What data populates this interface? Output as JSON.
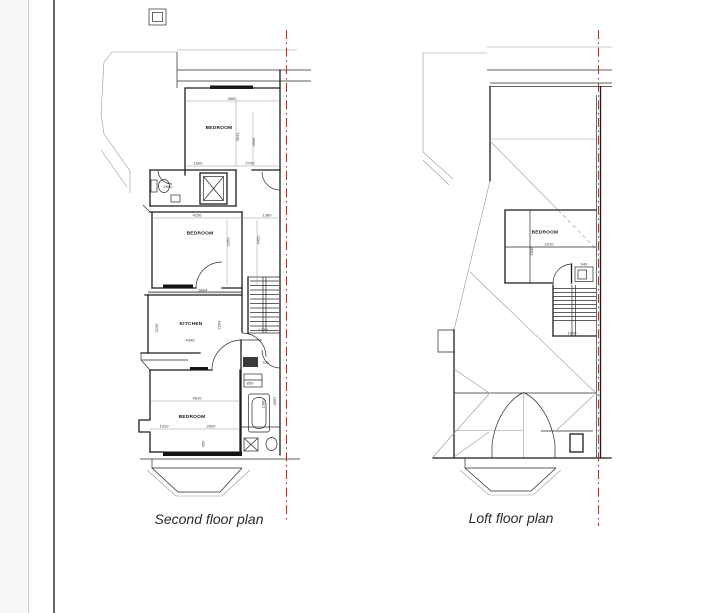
{
  "colors": {
    "boundary_red": "#b2382f",
    "wall_line": "#1c1c1c",
    "thin_line": "#9a9a9a",
    "page_gutter": "#f7f7f7"
  },
  "plans": {
    "second": {
      "caption": "Second floor plan",
      "room_labels": [
        "BEDROOM",
        "BEDROOM",
        "KITCHEN",
        "BEDROOM"
      ],
      "dims": [
        "4500",
        "3531",
        "4506",
        "2700",
        "1600",
        "2660",
        "4250",
        "1380",
        "2350",
        "3450",
        "5004",
        "3135",
        "2204",
        "4345",
        "1030",
        "700",
        "850",
        "1380",
        "4587",
        "4810",
        "1310",
        "2600",
        "450"
      ]
    },
    "loft": {
      "caption": "Loft floor plan",
      "room_labels": [
        "BEDROOM"
      ],
      "dims": [
        "2910",
        "1849",
        "940",
        "1800"
      ]
    }
  }
}
